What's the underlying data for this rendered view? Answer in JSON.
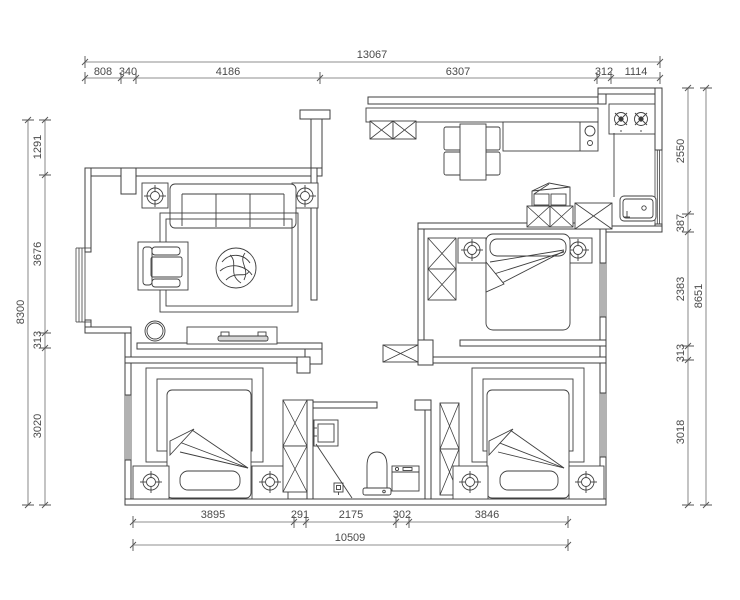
{
  "title": "apartment-floor-plan",
  "style": {
    "wall_color": "#3f3f3f",
    "dim_color": "#6a6a6a",
    "text_color": "#4a4a4a",
    "background": "#ffffff"
  },
  "dimensions": {
    "top": {
      "total": "13067",
      "segments": [
        "808",
        "340",
        "4186",
        "6307",
        "312",
        "1114"
      ]
    },
    "bottom": {
      "total": "10509",
      "segments": [
        "3895",
        "291",
        "2175",
        "302",
        "3846"
      ]
    },
    "left": {
      "total": "8300",
      "segments": [
        "1291",
        "3676",
        "313",
        "3020"
      ]
    },
    "right": {
      "total": "8651",
      "segments": [
        "2550",
        "387",
        "2383",
        "313",
        "3018"
      ]
    }
  }
}
